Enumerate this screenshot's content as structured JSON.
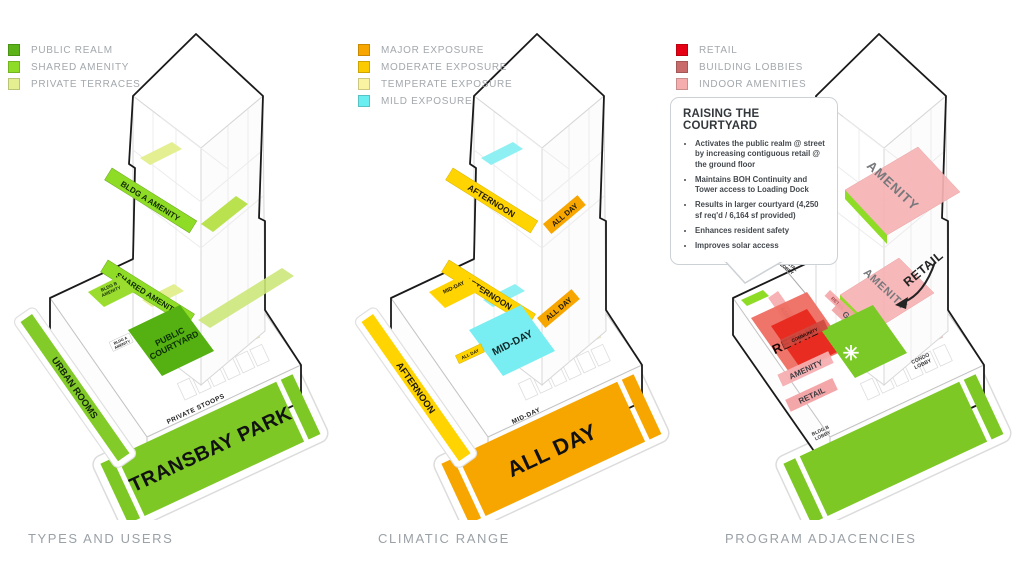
{
  "panels": [
    {
      "caption": "TYPES AND USERS",
      "legend": [
        {
          "label": "PUBLIC REALM",
          "color": "#5bb317"
        },
        {
          "label": "SHARED AMENITY",
          "color": "#8edc25"
        },
        {
          "label": "PRIVATE TERRACES",
          "color": "#e3ef90"
        }
      ],
      "diagram": {
        "band_upper": "BLDG A AMENITY",
        "band_lower": "SHARED AMENITY",
        "block_line1": "BLDG B",
        "block_line2": "AMENITY",
        "tiny_line1": "BLDG A",
        "tiny_line2": "AMENITY",
        "courtyard_line1": "PUBLIC",
        "courtyard_line2": "COURTYARD",
        "left_strip": "URBAN ROOMS",
        "edge_label": "PRIVATE STOOPS",
        "park_label": "TRANSBAY PARK",
        "park_color": "#7dc824",
        "courtyard_color": "#55b011"
      }
    },
    {
      "caption": "CLIMATIC RANGE",
      "legend": [
        {
          "label": "MAJOR EXPOSURE",
          "color": "#f7a600"
        },
        {
          "label": "MODERATE EXPOSURE",
          "color": "#fcca00"
        },
        {
          "label": "TEMPERATE EXPOSURE",
          "color": "#faf3a2"
        },
        {
          "label": "MILD EXPOSURE",
          "color": "#6beef0"
        }
      ],
      "diagram": {
        "band_upper": "AFTERNOON",
        "band_upper_tag": "ALL DAY",
        "band_lower": "AFTERNOON",
        "band_lower_tag": "ALL DAY",
        "block": "MID-DAY",
        "courtyard": "MID-DAY",
        "courtyard_tag": "ALL DAY",
        "left_strip": "AFTERNOON",
        "edge_label": "MID-DAY",
        "park_label": "ALL DAY",
        "park_color": "#f7a600",
        "courtyard_color": "#79eef2"
      }
    },
    {
      "caption": "PROGRAM ADJACENCIES",
      "legend": [
        {
          "label": "RETAIL",
          "color": "#e60014"
        },
        {
          "label": "BUILDING LOBBIES",
          "color": "#c96b6b"
        },
        {
          "label": "INDOOR AMENITIES",
          "color": "#f5adad"
        }
      ],
      "callout": {
        "title": "RAISING THE COURTYARD",
        "bullets": [
          "Activates the public realm @ street by increasing contiguous retail @ the ground floor",
          "Maintains BOH Continuity and Tower access to Loading Dock",
          "Results in larger courtyard (4,250 sf req'd / 6,164 sf provided)",
          "Enhances resident safety",
          "Improves solar access"
        ]
      },
      "diagram": {
        "slab_upper": "AMENITY",
        "slab_mid": "AMENITY",
        "retail_arrow": "RETAIL",
        "rental_lobby_line1": "RENTAL",
        "rental_lobby_line2": "LOBBY",
        "amenity_band": "AMENITY",
        "retail_big": "RETAIL",
        "retail_small": "RETAIL",
        "gym": "GYM",
        "community": "COMMUNITY",
        "amenity_mid": "AMENITY",
        "retail_low": "RETAIL",
        "condo_line1": "CONDO",
        "condo_line2": "LOBBY",
        "bldgb_line1": "BLDG B",
        "bldgb_line2": "LOBBY",
        "star": "✳",
        "park_color": "#7dc824",
        "courtyard_color": "#7ac926"
      }
    }
  ]
}
